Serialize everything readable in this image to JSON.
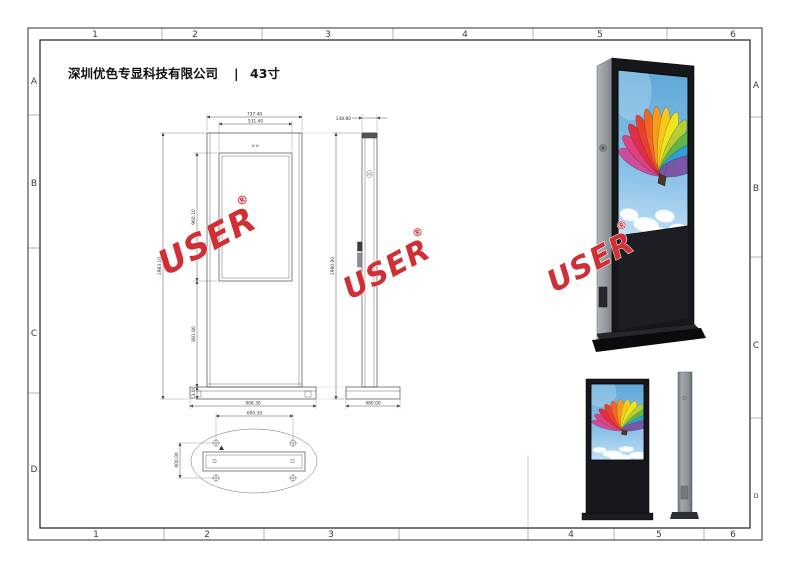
{
  "sheet": {
    "company": "深圳优色专显科技有限公司",
    "divider": "|",
    "model": "43寸"
  },
  "border": {
    "top": [
      "1",
      "2",
      "3",
      "4",
      "5",
      "6"
    ],
    "bottom": [
      "1",
      "2",
      "3",
      "4",
      "5",
      "6"
    ],
    "left": [
      "A",
      "B",
      "C",
      "D"
    ],
    "right": [
      "A",
      "B",
      "C",
      "D"
    ]
  },
  "watermark": {
    "text": "USER",
    "reg": "®",
    "color": "#d02f36"
  },
  "dimensions": {
    "front": {
      "overall_width": "737.40",
      "screen_width": "531.40",
      "overall_height": "1983.10",
      "screen_height": "960.10",
      "lower_height": "881.80",
      "base_height": "53.00",
      "base_width": "908.30"
    },
    "side": {
      "depth": "148.80",
      "overall_height": "1980.00",
      "base_depth": "480.00"
    },
    "bottom": {
      "bolt_spacing_x": "600.30",
      "bolt_spacing_y": "400.00"
    }
  },
  "render": {
    "sky_top": "#5fa8d8",
    "sky_bottom": "#c2e0f5",
    "cabinet_black": "#16171b",
    "cabinet_gray": "#9aa0a5",
    "balloon_colors": [
      "#c94f9b",
      "#e0407c",
      "#de2e48",
      "#e7402d",
      "#f06724",
      "#f59b1e",
      "#f6c918",
      "#eee51f",
      "#b3cf35",
      "#62b44e",
      "#2f9fd6",
      "#7a57a6"
    ]
  }
}
